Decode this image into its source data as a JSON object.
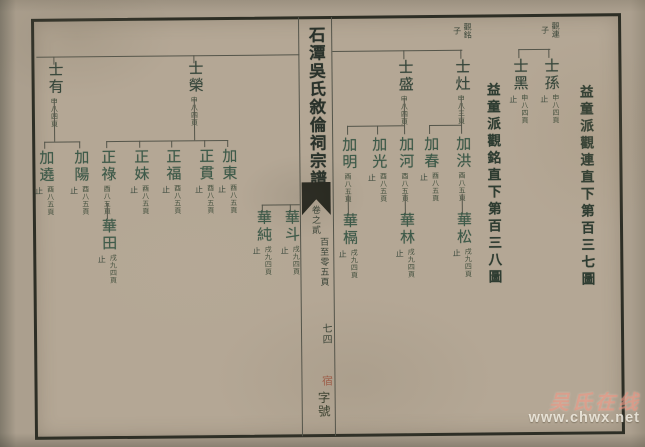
{
  "center_column": {
    "title": "石潭吳氏敘倫祠宗譜",
    "volume": "卷之貳",
    "page_range": "百至零五頁",
    "sheet_number": "七四",
    "stamp_char": "宿",
    "zihao_label": "字號"
  },
  "section_headers": [
    {
      "text": "益童派觀銘直下第百三八圖"
    },
    {
      "text": "益童派觀連直下第百三七圖"
    }
  ],
  "parent_labels": [
    {
      "name": "觀銘",
      "suffix": "子"
    },
    {
      "name": "觀連",
      "suffix": "子"
    }
  ],
  "tree": {
    "gen1": [
      {
        "name": "士有",
        "stop": "",
        "page": "申八四頁"
      },
      {
        "name": "士榮",
        "stop": "",
        "page": "申八四頁"
      },
      {
        "name": "士盛",
        "stop": "",
        "page": "申八四頁"
      },
      {
        "name": "士灶",
        "stop": "",
        "page": "申八三頁"
      },
      {
        "name": "士黑",
        "stop": "止",
        "page": "申八四頁"
      },
      {
        "name": "士孫",
        "stop": "止",
        "page": "申八四頁"
      }
    ],
    "gen2": [
      {
        "name": "加遶",
        "stop": "止",
        "page": "酉八五頁"
      },
      {
        "name": "加陽",
        "stop": "止",
        "page": "酉八五頁"
      },
      {
        "name": "正祿",
        "stop": "",
        "page": "酉八五頁"
      },
      {
        "name": "正妹",
        "stop": "止",
        "page": "酉八五頁"
      },
      {
        "name": "正福",
        "stop": "止",
        "page": "酉八五頁"
      },
      {
        "name": "正貫",
        "stop": "止",
        "page": "酉八五頁"
      },
      {
        "name": "加東",
        "stop": "止",
        "page": "酉八五頁"
      },
      {
        "name": "加明",
        "stop": "",
        "page": "酉八五頁"
      },
      {
        "name": "加光",
        "stop": "止",
        "page": "酉八五頁"
      },
      {
        "name": "加河",
        "stop": "",
        "page": "酉八五頁"
      },
      {
        "name": "加春",
        "stop": "止",
        "page": "酉八五頁"
      },
      {
        "name": "加洪",
        "stop": "",
        "page": "酉八五頁"
      }
    ],
    "gen3": [
      {
        "name": "華田",
        "stop": "止",
        "page": "戌九四頁"
      },
      {
        "name": "華純",
        "stop": "止",
        "page": "戌九四頁"
      },
      {
        "name": "華斗",
        "stop": "止",
        "page": "戌九四頁"
      },
      {
        "name": "華槅",
        "stop": "止",
        "page": "戌九四頁"
      },
      {
        "name": "華林",
        "stop": "止",
        "page": "戌九四頁"
      },
      {
        "name": "華松",
        "stop": "止",
        "page": "戌九四頁"
      }
    ]
  },
  "watermark": {
    "site_name": "吴氏在线",
    "site_url": "www.chwx.net"
  }
}
